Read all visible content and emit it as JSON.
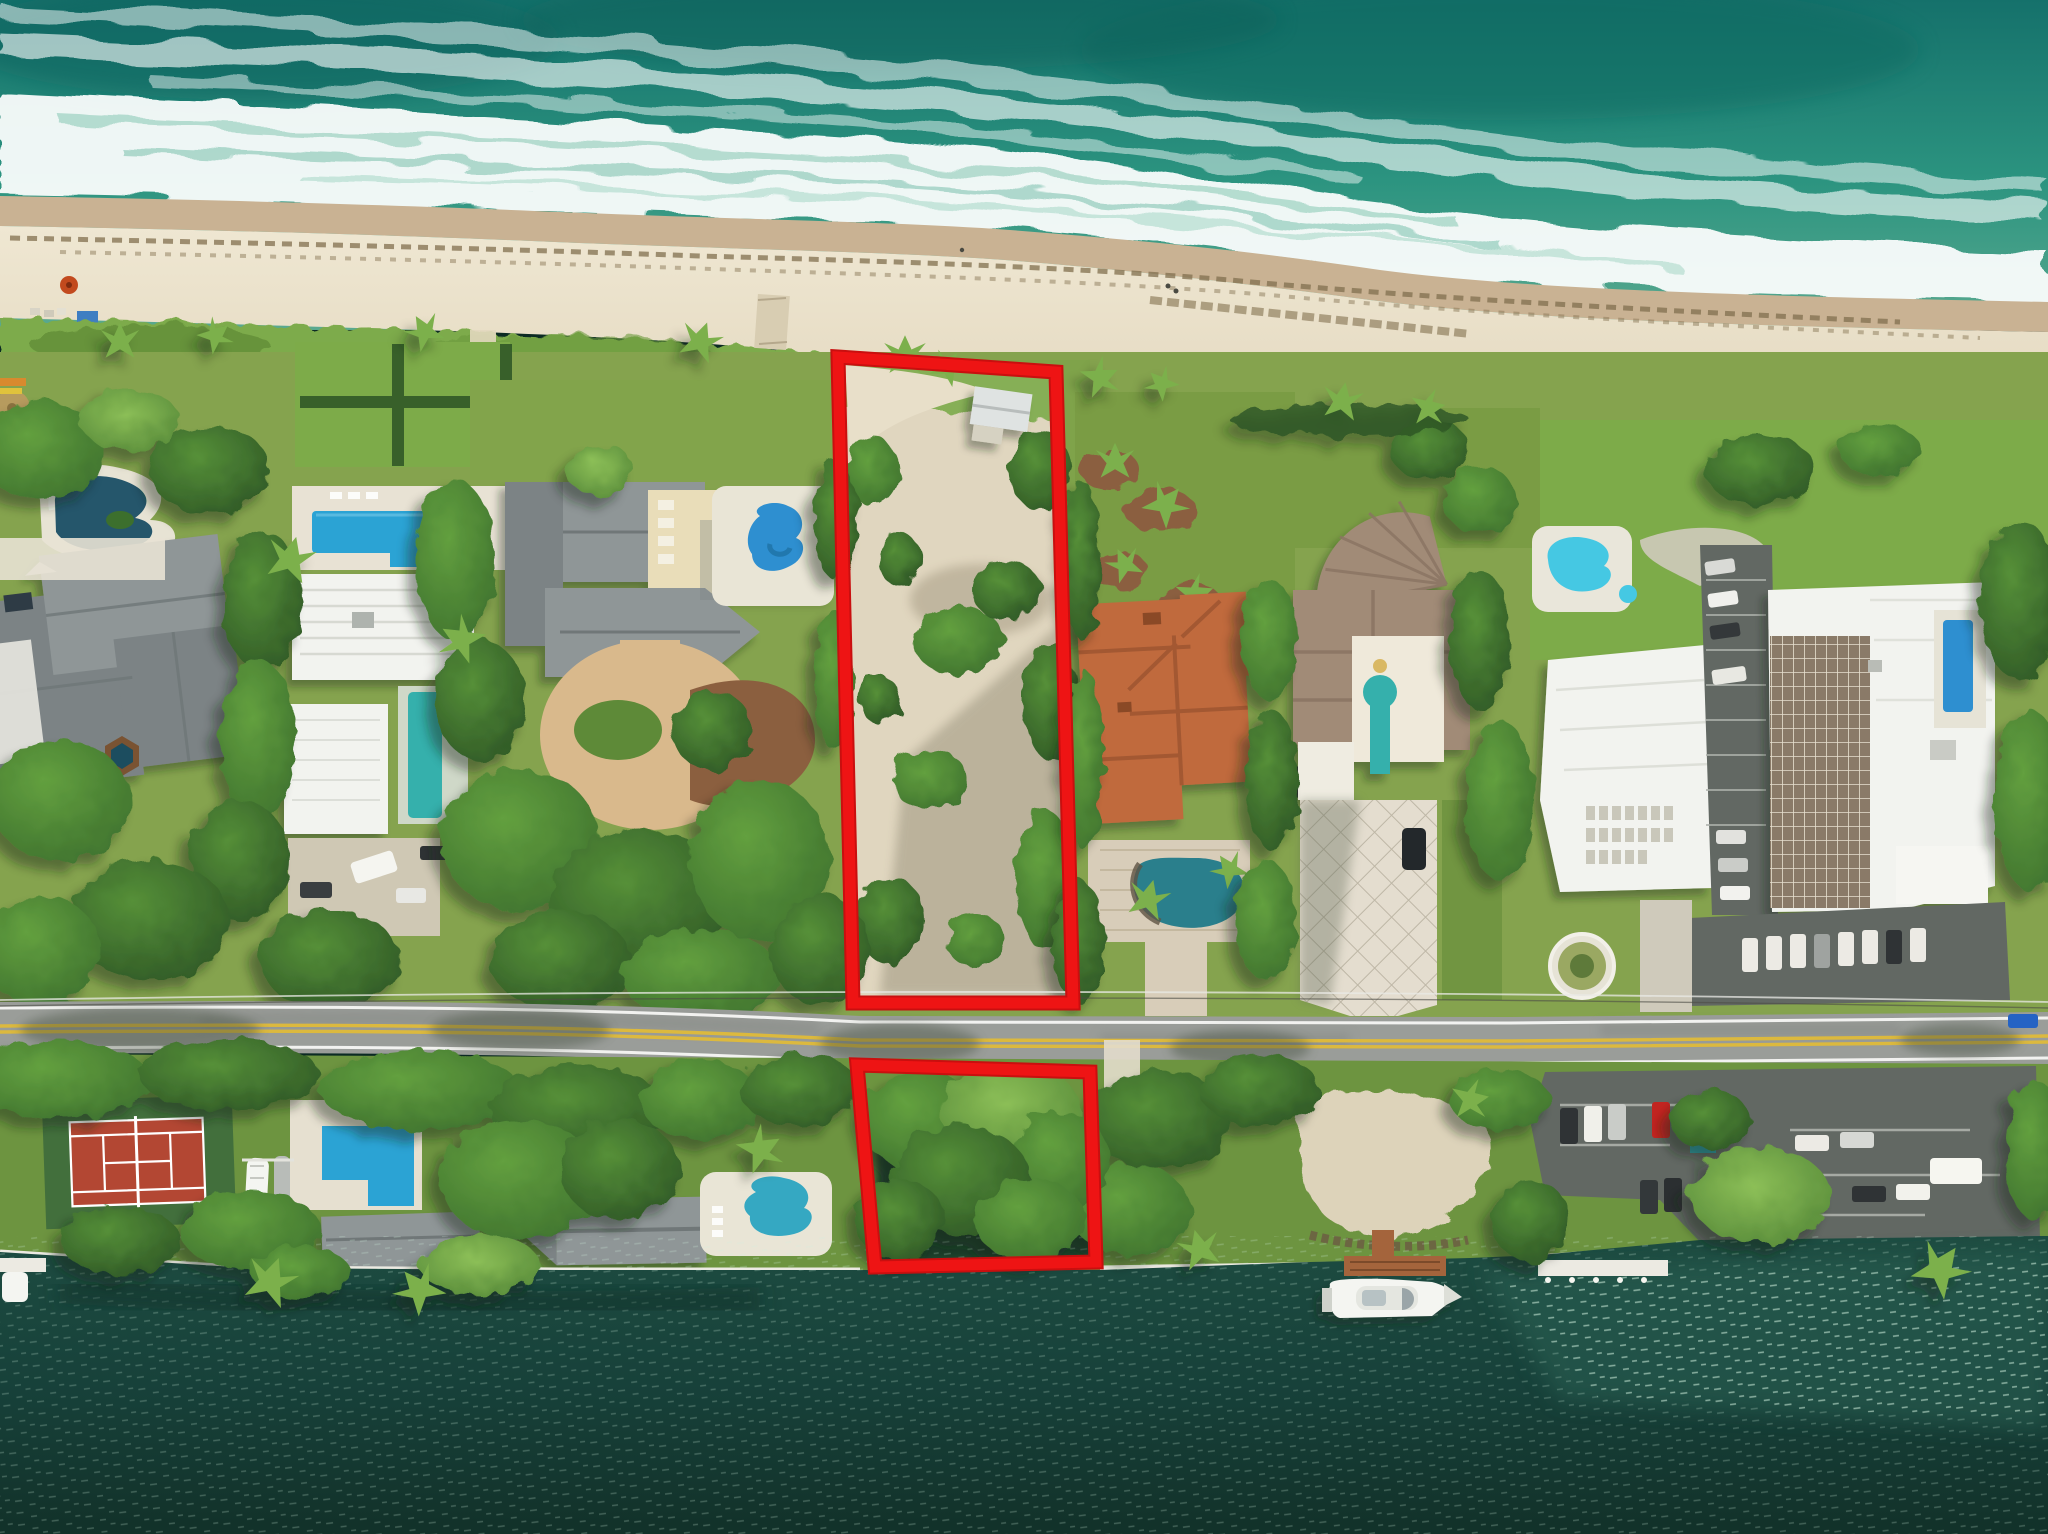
{
  "scene": {
    "kind": "aerial-drone-photo",
    "description": "Vertical aerial photo of an oceanfront strip: turquoise surf and sandy beach at top, a row of luxury estates with pools between the beach and a two-lane coastal road, dark intracoastal water at the bottom with docks and a white yacht. Two vacant parcels are outlined in thick red: a large beachfront lot in the center and a smaller waterfront lot south of the road.",
    "visible_text": "none",
    "parcel_count": 2
  },
  "parcels": {
    "outline_color": "#ee1414",
    "beachfront_lot_points": "838,357 1056,372 1073,1003 853,1003",
    "waterfront_lot_points": "857,1065 1090,1072 1096,1262 875,1267"
  },
  "objects": {
    "ocean": "teal surf with white foam bands",
    "beach": "cream sand with seaweed wrack lines, umbrella and loungers",
    "dune": "bright green coastal scrub band",
    "estates": [
      "slate-gray roof mansion with lagoon pool and spa",
      "modern white flat-roof house with two blue lap pools",
      "gray hip-roof estate with freeform pool and circular drive",
      "terracotta tile-roof mansion with rock lagoon pool",
      "tan fan-roof mansion with keyhole courtyard pool and diamond-paver drive"
    ],
    "condo": "white mid-rise buildings with brown balcony grid, kidney pool, lap pool, parking lots and fountain circle",
    "road": "two-lane road, white edge lines, double yellow center line, overhanging trees",
    "south_shore": [
      "tennis court",
      "boats on lifts",
      "bright blue pool",
      "gray waterfront houses",
      "freeform pool",
      "brown T-dock",
      "white motor yacht",
      "long white dock",
      "waterfront parking lot"
    ],
    "water": "dark green intracoastal with wind-ripple sparkle"
  },
  "colors": {
    "oceanDeep": "#15716b",
    "oceanMid": "#2c9480",
    "oceanShallow": "#5aa98f",
    "foam": "#ffffff",
    "wetSand": "#c9b293",
    "seaweed": "#82704f",
    "sand": "#e3d8bf",
    "sandLight": "#efe7d2",
    "sandShadow": "#bfb49a",
    "duneGreen": "#7dab4b",
    "duneDark": "#55802f",
    "lawn": "#85a34e",
    "lawnBright": "#7dab49",
    "lawnDark": "#5e8a38",
    "treeDark": "#2c5425",
    "treeMid": "#3c6f2d",
    "treeLight": "#569038",
    "palm": "#7cb04c",
    "roofGray": "#8f9697",
    "roofGrayDark": "#6f7778",
    "roofSlate": "#7b8385",
    "roofWhite": "#f2f3ef",
    "roofWhiteShade": "#d9dbd5",
    "wallCream": "#e9ddb9",
    "terracotta": "#c06a3e",
    "terracottaDark": "#9e5530",
    "roofTan": "#a18b77",
    "roofTanDark": "#8a7463",
    "balconyBrown": "#8a7a68",
    "balconyLine": "#e8e0d0",
    "poolBlue": "#2ba3d4",
    "poolAzure": "#2e8fd0",
    "poolTeal": "#35b0ac",
    "poolCyan": "#45c8e3",
    "poolLagoon": "#25566b",
    "paveLight": "#e8e2d4",
    "paver": "#d9c9a8",
    "mulch": "#8b5f3f",
    "driveTan": "#d9b98c",
    "roadGray": "#9a9d99",
    "roadDark": "#848783",
    "roadLine": "#f2f2f0",
    "roadYellow": "#dcb93e",
    "asphalt": "#626863",
    "asphaltDark": "#51564f",
    "waterDark": "#1d4c41",
    "waterDeep": "#123129",
    "waterRight": "#2a6052",
    "sparkle": "#cfeedd",
    "court": "#b34733",
    "courtGreen": "#426f3c",
    "dock": "#a4643c",
    "dockWhite": "#eceae2",
    "boat": "#f4f5f1",
    "parcelRed": "#ee1414",
    "parcelRedDark": "#c90f0f"
  }
}
